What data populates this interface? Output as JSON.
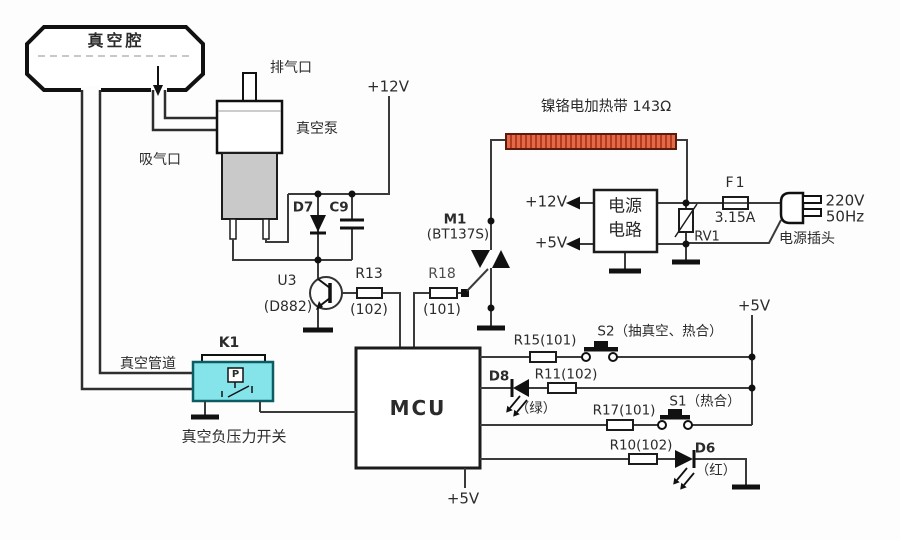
{
  "colors": {
    "wire": "#3B3B3B",
    "outline": "#1C1C1C",
    "heater_fill": "#E16A49",
    "heater_stripe": "#B63A20",
    "heater_border": "#5E1B0C",
    "pressure_switch_fill": "#85E4EA",
    "pressure_switch_border": "#0D5C63",
    "motor_fill": "#C9C9C9",
    "text": "#2B2B2B"
  },
  "vacuum": {
    "chamber": "真空腔",
    "exhaust_port": "排气口",
    "pump": "真空泵",
    "intake_port": "吸气口",
    "pipe": "真空管道",
    "switch_ref": "K1",
    "switch_label": "真空负压力开关",
    "sensor_letter": "P"
  },
  "pump_driver": {
    "supply": "+12V",
    "diode_ref": "D7",
    "capacitor_ref": "C9",
    "transistor_ref": "U3",
    "transistor_part": "(D882)",
    "r13_ref": "R13",
    "r13_value": "(102)",
    "r18_ref": "R18",
    "r18_value": "(101)"
  },
  "heater": {
    "label": "镍铬电加热带 143Ω",
    "triac_ref": "M1",
    "triac_part": "(BT137S)"
  },
  "mains": {
    "psu_line1": "电源",
    "psu_line2": "电路",
    "out_12v": "+12V",
    "out_5v": "+5V",
    "fuse_ref": "F1",
    "fuse_rating": "3.15A",
    "varistor_ref": "RV1",
    "voltage": "220V",
    "frequency": "50Hz",
    "plug_label": "电源插头"
  },
  "mcu": {
    "chip_label": "MCU",
    "supply": "+5V",
    "rail_supply": "+5V",
    "r15": "R15(101)",
    "s2": "S2（抽真空、热合）",
    "d8_ref": "D8",
    "d8_color": "（绿）",
    "r11": "R11(102)",
    "r17": "R17(101)",
    "s1": "S1（热合）",
    "r10": "R10(102)",
    "d6_ref": "D6",
    "d6_color": "（红）"
  }
}
